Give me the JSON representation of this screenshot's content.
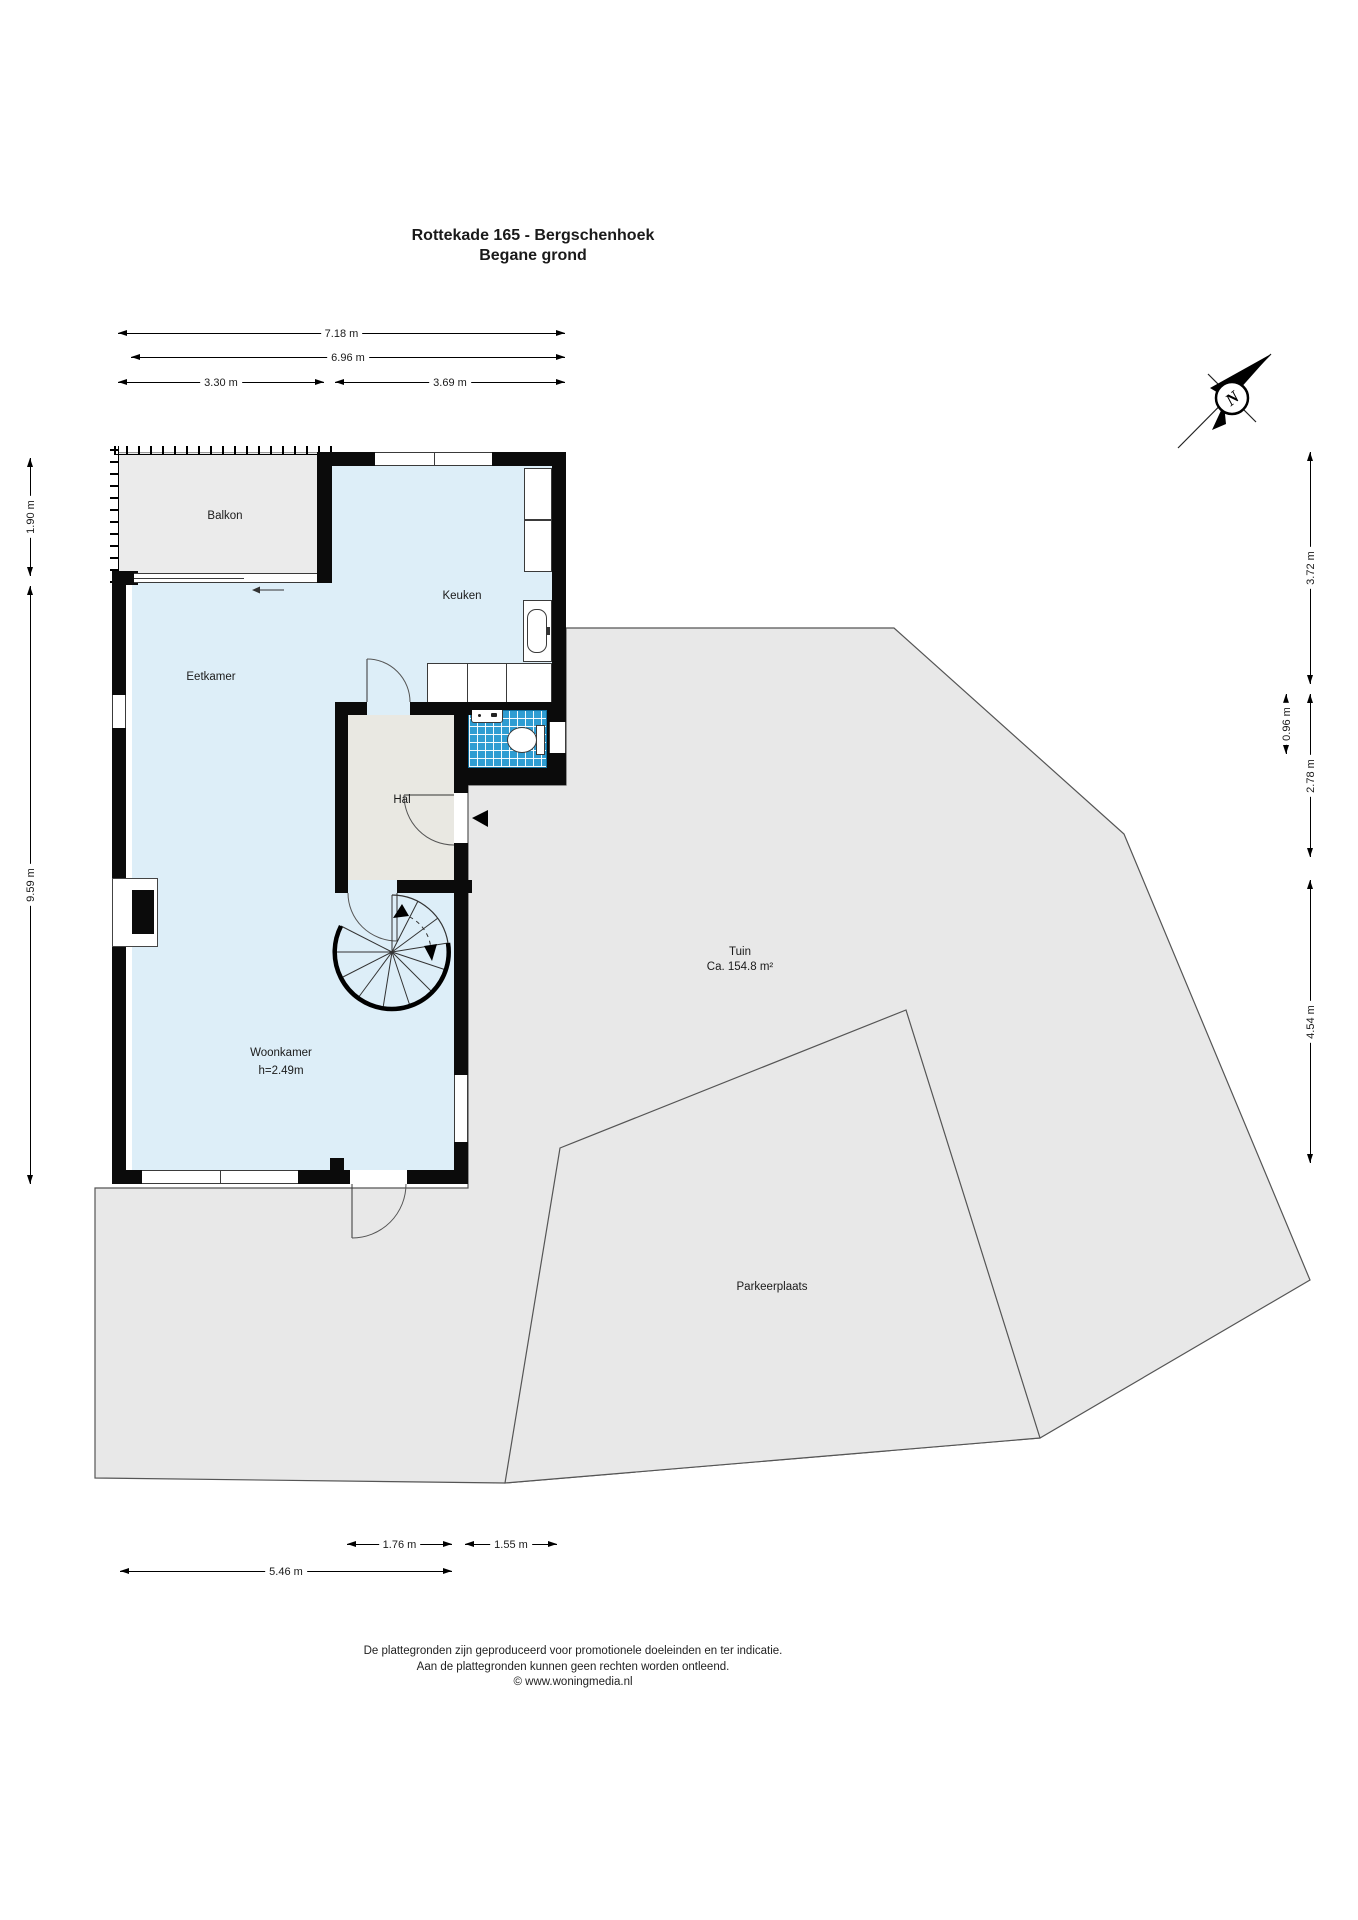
{
  "title": {
    "address": "Rottekade 165 - Bergschenhoek",
    "floor": "Begane grond"
  },
  "compass": {
    "north_label": "N"
  },
  "rooms": {
    "balkon": {
      "label": "Balkon"
    },
    "keuken": {
      "label": "Keuken"
    },
    "eetkamer": {
      "label": "Eetkamer"
    },
    "hal": {
      "label": "Hal"
    },
    "woonkamer": {
      "label": "Woonkamer",
      "ceiling_height": "h=2.49m"
    },
    "tuin": {
      "label": "Tuin",
      "area": "Ca. 154.8 m²"
    },
    "parkeerplaats": {
      "label": "Parkeerplaats"
    }
  },
  "dimensions": {
    "top": [
      {
        "label": "7.18 m"
      },
      {
        "label": "6.96 m"
      },
      {
        "label": "3.30 m"
      },
      {
        "label": "3.69 m"
      }
    ],
    "left": [
      {
        "label": "1.90 m"
      },
      {
        "label": "9.59 m"
      }
    ],
    "right": [
      {
        "label": "3.72 m"
      },
      {
        "label": "0.96 m"
      },
      {
        "label": "2.78 m"
      },
      {
        "label": "4.54 m"
      }
    ],
    "bottom": [
      {
        "label": "1.76 m"
      },
      {
        "label": "1.55 m"
      },
      {
        "label": "5.46 m"
      }
    ]
  },
  "footer": {
    "line1": "De plattegronden zijn geproduceerd voor promotionele doeleinden en ter indicatie.",
    "line2": "Aan de plattegronden kunnen geen rechten worden ontleend.",
    "line3": "© www.woningmedia.nl"
  },
  "colors": {
    "room_fill": "#ddeef8",
    "hall_fill": "#e9e8e2",
    "outdoor_fill": "#e8e8e8",
    "balcony_fill": "#ebebeb",
    "tile_fill": "#2f9dd2",
    "wall": "#0b0b0b"
  }
}
